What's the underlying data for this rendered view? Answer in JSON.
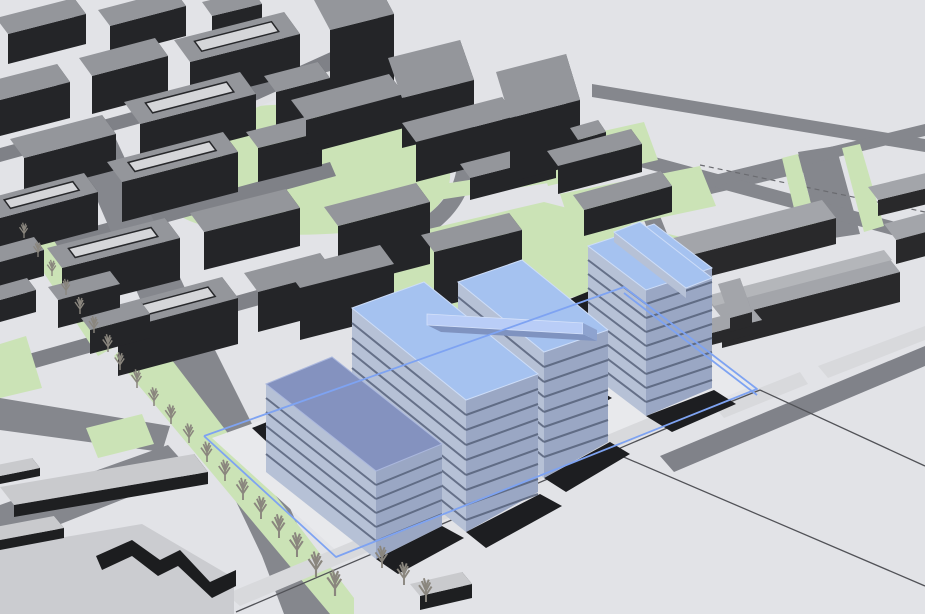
{
  "meta": {
    "type": "3d-city-massing-model",
    "view": "aerial-perspective-view",
    "description": "Urban development massing study: dark existing city blocks with a proposed development of blue transparent buildings inside a blue site boundary"
  },
  "viewport": {
    "width": 925,
    "height": 614
  },
  "palette": {
    "ground": "#e2e3e7",
    "parcel_ground": "#e8e9ec",
    "road": "#85878d",
    "street": "#7f8187",
    "green": "#cbe3b6",
    "existing_roof": "#94969b",
    "existing_front": "#242528",
    "existing_side": "#3a3d40",
    "light_complex_roof": "#a3a5aa",
    "flat_roof": "#c9cacd",
    "proposed_roof": "#a5c2f0",
    "proposed_roof_muted": "#8492bf",
    "proposed_face": "#b6c1d6",
    "slab_line": "#57627b",
    "site_boundary": "#7ea3f2",
    "parcel_line": "#515257",
    "shadow": "#1d1e21",
    "tree": "#8a867e",
    "path_band": "#d8d9dc"
  },
  "scene": {
    "existing_city_blocks": {
      "count": 30,
      "style": "dark gray extruded blocks with light gray roofs, several perimeter blocks with inner courtyards, two tall towers at top center"
    },
    "proposed_buildings": [
      {
        "id": "proposed-block-1",
        "visible_floors": 5,
        "roof_tone": "muted blue"
      },
      {
        "id": "proposed-block-2",
        "visible_floors": 8,
        "roof_tone": "light blue"
      },
      {
        "id": "proposed-block-3",
        "visible_floors": 7,
        "roof_tone": "light blue",
        "feature": "elevated rooftop bar"
      },
      {
        "id": "proposed-block-4",
        "visible_floors": 8,
        "roof_tone": "light blue",
        "feature": "tallest tower with perpendicular rooftop bar"
      },
      {
        "id": "proposed-block-5",
        "visible_floors": 3,
        "roof_tone": "light blue",
        "feature": "low annex"
      }
    ],
    "site_boundary": {
      "style": "blue wireframe parcel outline crossing the proposed buildings"
    },
    "park": {
      "shape": "large oval lawn with curved ring road at top center"
    },
    "green_areas_count": 10,
    "trees": {
      "count": 23,
      "type": "bare winter street trees",
      "arrangement": "rows along the diagonal avenue"
    },
    "parcel_lines": {
      "style": "thin dark survey lines over empty parcels",
      "dashed_segment": true
    },
    "right_complex": {
      "style": "lighter gray institutional buildings with vaulted roof, lower right of site"
    }
  }
}
